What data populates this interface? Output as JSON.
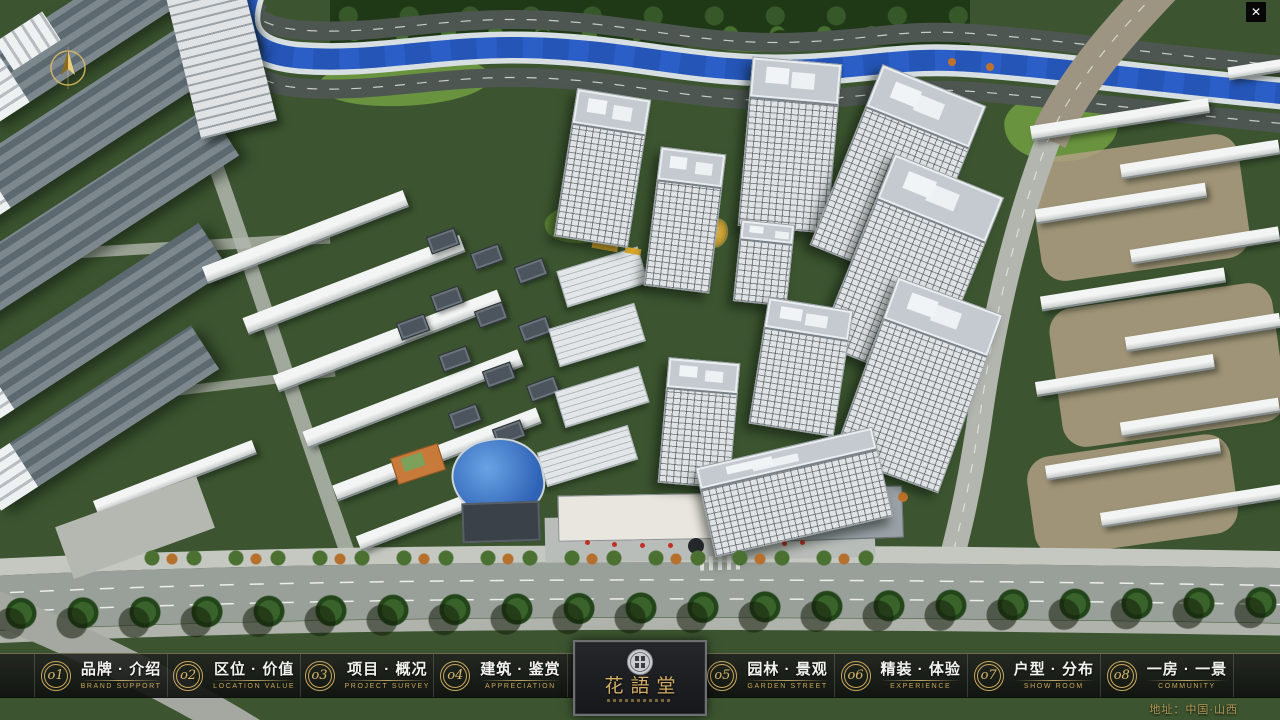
{
  "window": {
    "close_glyph": "✕"
  },
  "nav": {
    "items": [
      {
        "num": "o1",
        "zh": "品牌 · 介绍",
        "en": "BRAND SUPPORT"
      },
      {
        "num": "o2",
        "zh": "区位 · 价值",
        "en": "LOCATION VALUE"
      },
      {
        "num": "o3",
        "zh": "项目 · 概况",
        "en": "PROJECT SURVEY"
      },
      {
        "num": "o4",
        "zh": "建筑 · 鉴赏",
        "en": "APPRECIATION"
      },
      {
        "num": "o5",
        "zh": "园林 · 景观",
        "en": "GARDEN STREET"
      },
      {
        "num": "o6",
        "zh": "精装 · 体验",
        "en": "EXPERIENCE"
      },
      {
        "num": "o7",
        "zh": "户型 · 分布",
        "en": "SHOW ROOM"
      },
      {
        "num": "o8",
        "zh": "一房 · 一景",
        "en": "COMMUNITY"
      }
    ]
  },
  "logo": {
    "title": "花語堂"
  },
  "footer": {
    "address": "地址：中国·山西"
  },
  "colors": {
    "gold": "#c9a55c",
    "bar_background": "rgba(22,24,22,0.88)",
    "river_blue": "#2b5fc7",
    "text_white": "#f2f2ef"
  }
}
